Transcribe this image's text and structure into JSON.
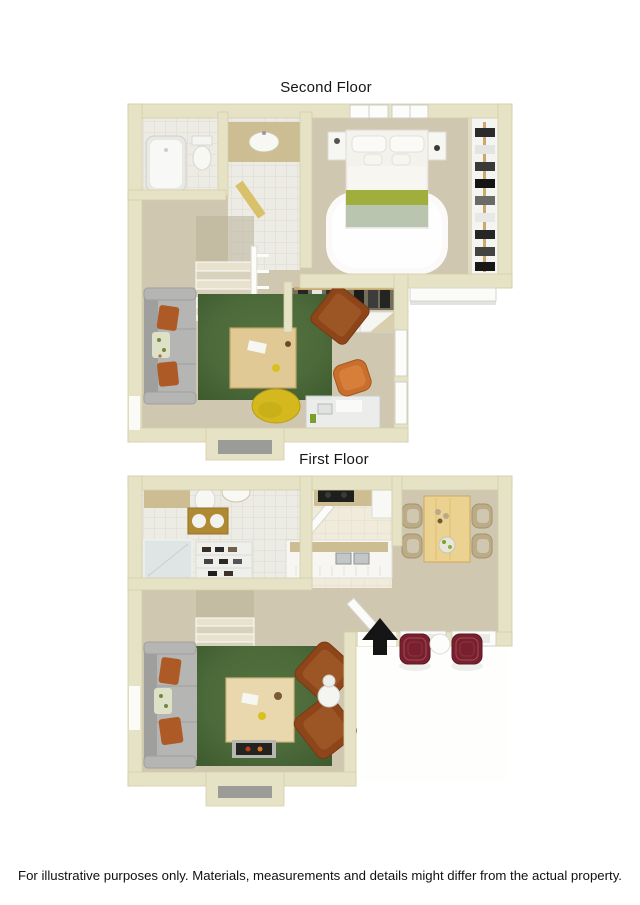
{
  "page": {
    "background": "#ffffff",
    "width": 640,
    "height": 905
  },
  "titles": {
    "second_floor": "Second Floor",
    "first_floor": "First Floor"
  },
  "footer": {
    "disclaimer": "For illustrative purposes only.  Materials, measurements and details might differ from the actual property."
  },
  "palette": {
    "wall": "#e6e2c6",
    "wallEdge": "#d4cea9",
    "carpet": "#cfc7b0",
    "carpetDark": "#b9b098",
    "tile": "#ecebe4",
    "tileLine": "#dcdad0",
    "kitchenTile": "#f0ebdb",
    "counter": "#cdbd92",
    "wood": "#e0c995",
    "woodEdge": "#c3a366",
    "woodLight": "#ecd290",
    "rug": "#4c6a3a",
    "rugDark": "#3d5a2e",
    "couch": "#b5b5b3",
    "couchDark": "#9f9f9d",
    "pillow": "#ad5a26",
    "leather": "#8d4519",
    "leatherDark": "#773a12",
    "leatherInner": "#9c5524",
    "yellow": "#d4b81d",
    "maroon": "#78202e",
    "offwhite": "#f6f5f1",
    "white": "#ffffff",
    "glass": "#dfe4e4",
    "dark": "#1e1e1c",
    "gray": "#9b9b97",
    "green": "#9fae3c",
    "sage": "#bac5b0",
    "arrow": "#151515"
  },
  "floors": [
    {
      "name": "Second Floor",
      "rooms": [
        "Bathroom",
        "Vanity",
        "Bedroom",
        "Wardrobe",
        "Hall Closet",
        "Loft",
        "Stairs"
      ],
      "furniture": [
        "bathtub",
        "toilet",
        "vanity sink",
        "bed with green throw",
        "nightstands",
        "white area rug",
        "hanging clothes",
        "sliding closet doors",
        "gray sofa",
        "green rug",
        "coffee table",
        "accent chair",
        "yellow bean bag",
        "desk",
        "desk chair"
      ]
    },
    {
      "name": "First Floor",
      "rooms": [
        "Bathroom",
        "Kitchen",
        "Dining",
        "Living Room",
        "Stairs",
        "Patio"
      ],
      "furniture": [
        "toilet",
        "oval sink",
        "shower",
        "double-basin counter",
        "shoe closet",
        "range",
        "refrigerator",
        "breakfast bar with double sink",
        "dining table",
        "four dining chairs",
        "gray sofa",
        "green rug",
        "coffee table",
        "two leather armchairs",
        "round side table",
        "fireplace",
        "entry arrow",
        "two patio chairs",
        "patio table"
      ]
    }
  ]
}
